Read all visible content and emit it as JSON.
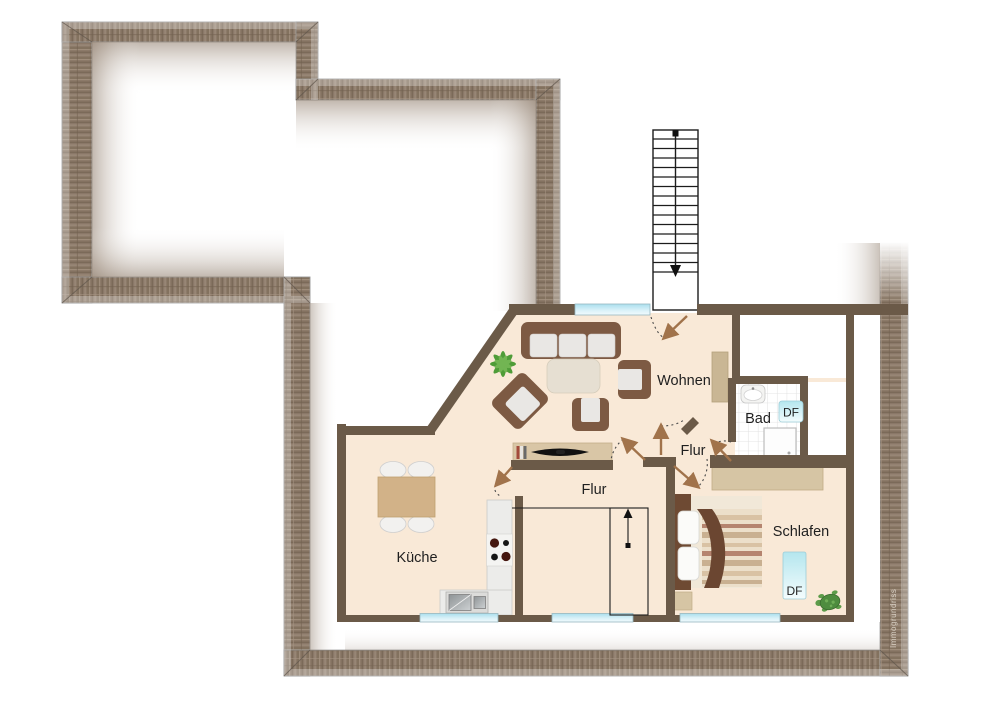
{
  "plan": {
    "watermark": "Immogrundriss",
    "rooms": [
      {
        "id": "wohnen",
        "label": "Wohnen"
      },
      {
        "id": "bad",
        "label": "Bad"
      },
      {
        "id": "flur-oben",
        "label": "Flur"
      },
      {
        "id": "flur-unten",
        "label": "Flur"
      },
      {
        "id": "kueche",
        "label": "Küche"
      },
      {
        "id": "schlafen",
        "label": "Schlafen"
      }
    ],
    "roof_windows": [
      {
        "id": "df-bad",
        "label": "DF"
      },
      {
        "id": "df-schlafen",
        "label": "DF"
      }
    ],
    "colors": {
      "floor": "#f9e9d7",
      "interior_wall": "#6b5a48",
      "outer_wall": "#8c7a69",
      "window": "#b9e4f0",
      "door_leaf": "#a1734b",
      "furniture_wood": "#7d5a43"
    }
  }
}
